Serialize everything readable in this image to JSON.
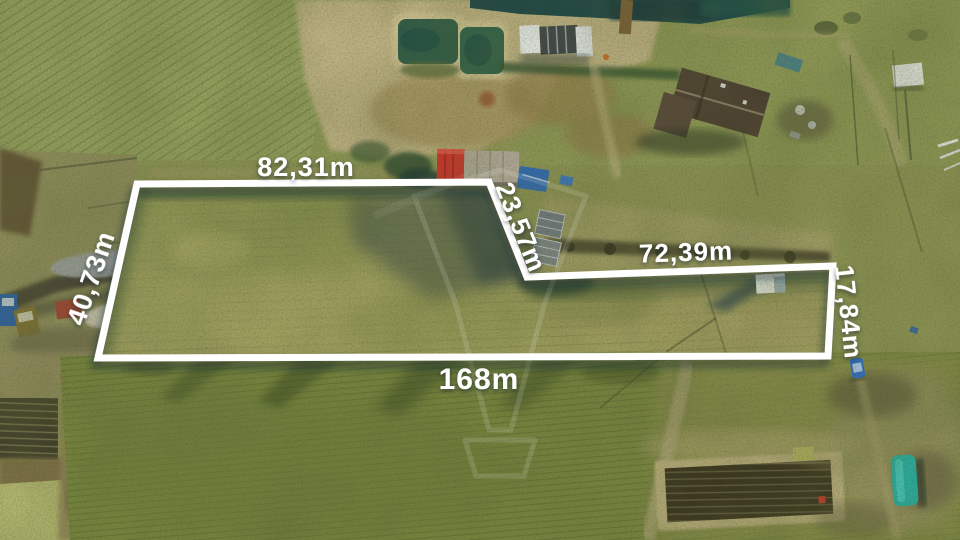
{
  "photo": {
    "overlay": {
      "boundary_color": "#ffffff",
      "label_color": "#ffffff",
      "measurements": {
        "top_edge": "82,31m",
        "diagonal_edge": "23,57m",
        "right_section_top_edge": "72,39m",
        "right_edge": "17,84m",
        "bottom_edge": "168m",
        "left_edge": "40,73m"
      },
      "watermark_icon": "balloon-outline-watermark"
    },
    "accent_colors": {
      "boundary": "#ffffff",
      "red_container": "#cd312a",
      "green_tarp": "#2ba89a",
      "pond_water": "#2e5a47",
      "top_water": "#1a4347"
    }
  }
}
